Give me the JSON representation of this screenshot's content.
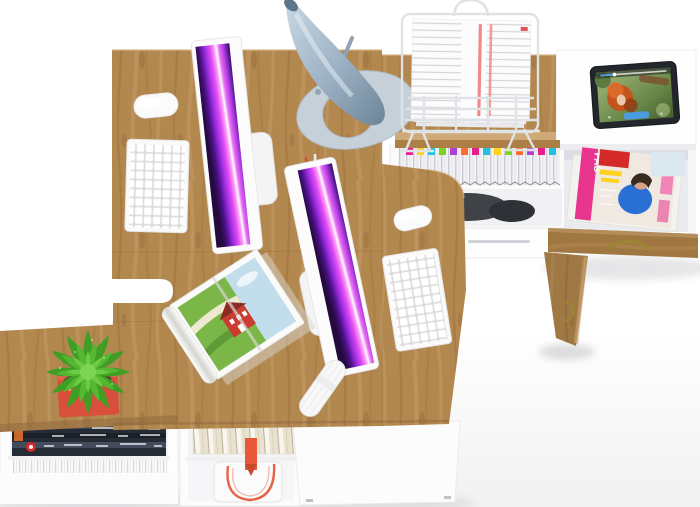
{
  "scene": {
    "title": "Top-down 3D render of a white and oak two-person office workstation",
    "canvas": {
      "width": 700,
      "height": 507
    }
  },
  "palette": {
    "background": "#ffffff",
    "floor": "#f0f0f1",
    "wood": "#b3884f",
    "wood_grain_dark": "#9c7040",
    "wood_grain_light": "#c49a68",
    "wood_edge_light": "#cfa977",
    "white_furniture": "#fdfdfe",
    "furniture_edge": "#e9e9ec",
    "cavity": "#e9ebee",
    "screen_dark": "#240a3d",
    "screen_violet": "#9b2be0",
    "screen_magenta": "#e14df2",
    "screen_highlight": "#ffffff",
    "device_white": "#f9f9fa",
    "key_gap": "#dcdcdc",
    "lamp_metal_light": "#c9d8e4",
    "lamp_metal_dark": "#6d8599",
    "lamp_base": "#c5d0d9",
    "pen_red": "#d9513b",
    "pen_green": "#7dc242",
    "pen_gray": "#9aa2ab",
    "pen_cup_gray": "#565c64",
    "plant_dark": "#3f9e24",
    "plant_mid": "#55b832",
    "plant_light": "#6ecb45",
    "plant_center": "#7ed455",
    "pot_red": "#d8503b",
    "pot_rim": "#e2654e",
    "soil_brown": "#5a4030",
    "brass": "#9b8432",
    "bag_strap_orange": "#e8593a",
    "paper_stripe_red": "#f08a8a",
    "magazine_pink": "#e8368f",
    "magazine_red": "#d42a2a",
    "magazine_yellow": "#ffd21e",
    "magazine_blue": "#2a6fd4",
    "skin": "#d8a284",
    "dark_hair": "#3a2a20",
    "dark_items": "#3f4347",
    "magazine_stack_navy": "#262c36",
    "tablet_body": "#23272c",
    "video_hair_orange": "#c4541f",
    "player_blue": "#4a9de8",
    "wire_gray": "#dfe3e6",
    "file_tabs": [
      "#e91e8c",
      "#ffd21e",
      "#22c1e0",
      "#7ed321",
      "#b03fd4",
      "#ff6d2e",
      "#e91e8c",
      "#22c1e0",
      "#ffd21e",
      "#7ed321",
      "#ff6d2e",
      "#b03fd4",
      "#e91e8c",
      "#22c1e0"
    ]
  },
  "texts": {
    "magazine_cover": "FAS"
  },
  "objects": {
    "desk": "L-shaped oak-top double workstation",
    "side_table": "white side table with open drawer full of magazines",
    "monitor": "white all-in-one computer with purple abstract wallpaper",
    "keyboard": "white wireless keyboard",
    "mouse": "white wireless mouse",
    "lamp": "steel-blue cone desk lamp",
    "paper_tray": "white wire document stand holding papers",
    "file_drawer": "hanging files with colored index tabs",
    "tablet": "black tablet playing an animated movie",
    "plant": "green succulent in a red square pot",
    "open_magazine": "open magazine with countryside photo",
    "cable": "coiled white cable",
    "shelves": "white under-desk shelves with magazines, books and tote bag",
    "open_door": "oak cabinet door ajar with brass handle"
  }
}
